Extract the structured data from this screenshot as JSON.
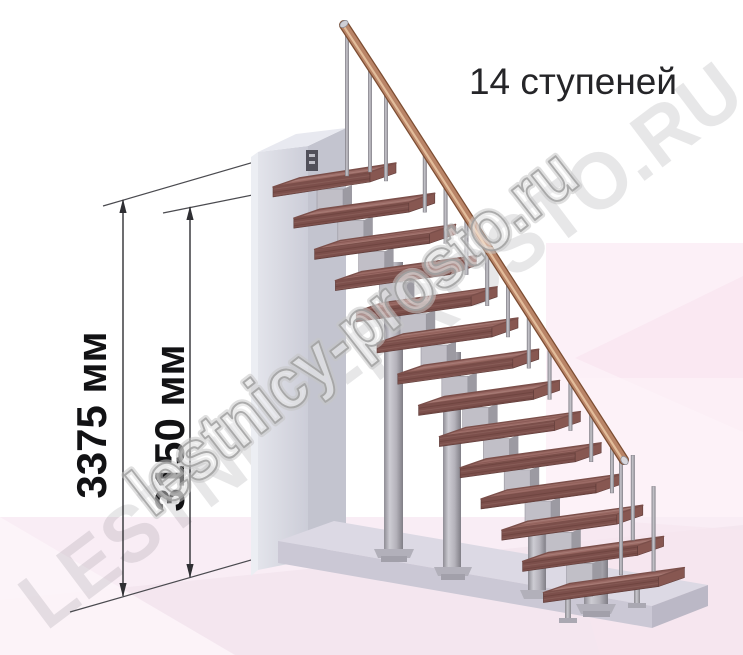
{
  "title": "14 ступеней",
  "dimensions": {
    "total_height": "3375 мм",
    "flight_height": "3150 мм"
  },
  "watermark": {
    "large": "LESTNICY-PROSTO.RU",
    "small": "lestnicy-prosto.ru"
  },
  "stairs": {
    "steps": 14,
    "colors": {
      "tread_top": "#9b6b66",
      "tread_front": "#7c4f4b",
      "tread_side": "#875751",
      "handrail": "#b98467",
      "handrail_dark": "#7c4d32",
      "handrail_highlight": "#e9c7a5",
      "metal": "#c1bfc7",
      "metal_dark": "#98969e",
      "wall": "#d8d9e1",
      "platform": "#dcd9e4",
      "floor_pink": "#f9edf5",
      "accent_pink": "#fcf0f7",
      "dimension_ink": "#2f2f33"
    }
  }
}
